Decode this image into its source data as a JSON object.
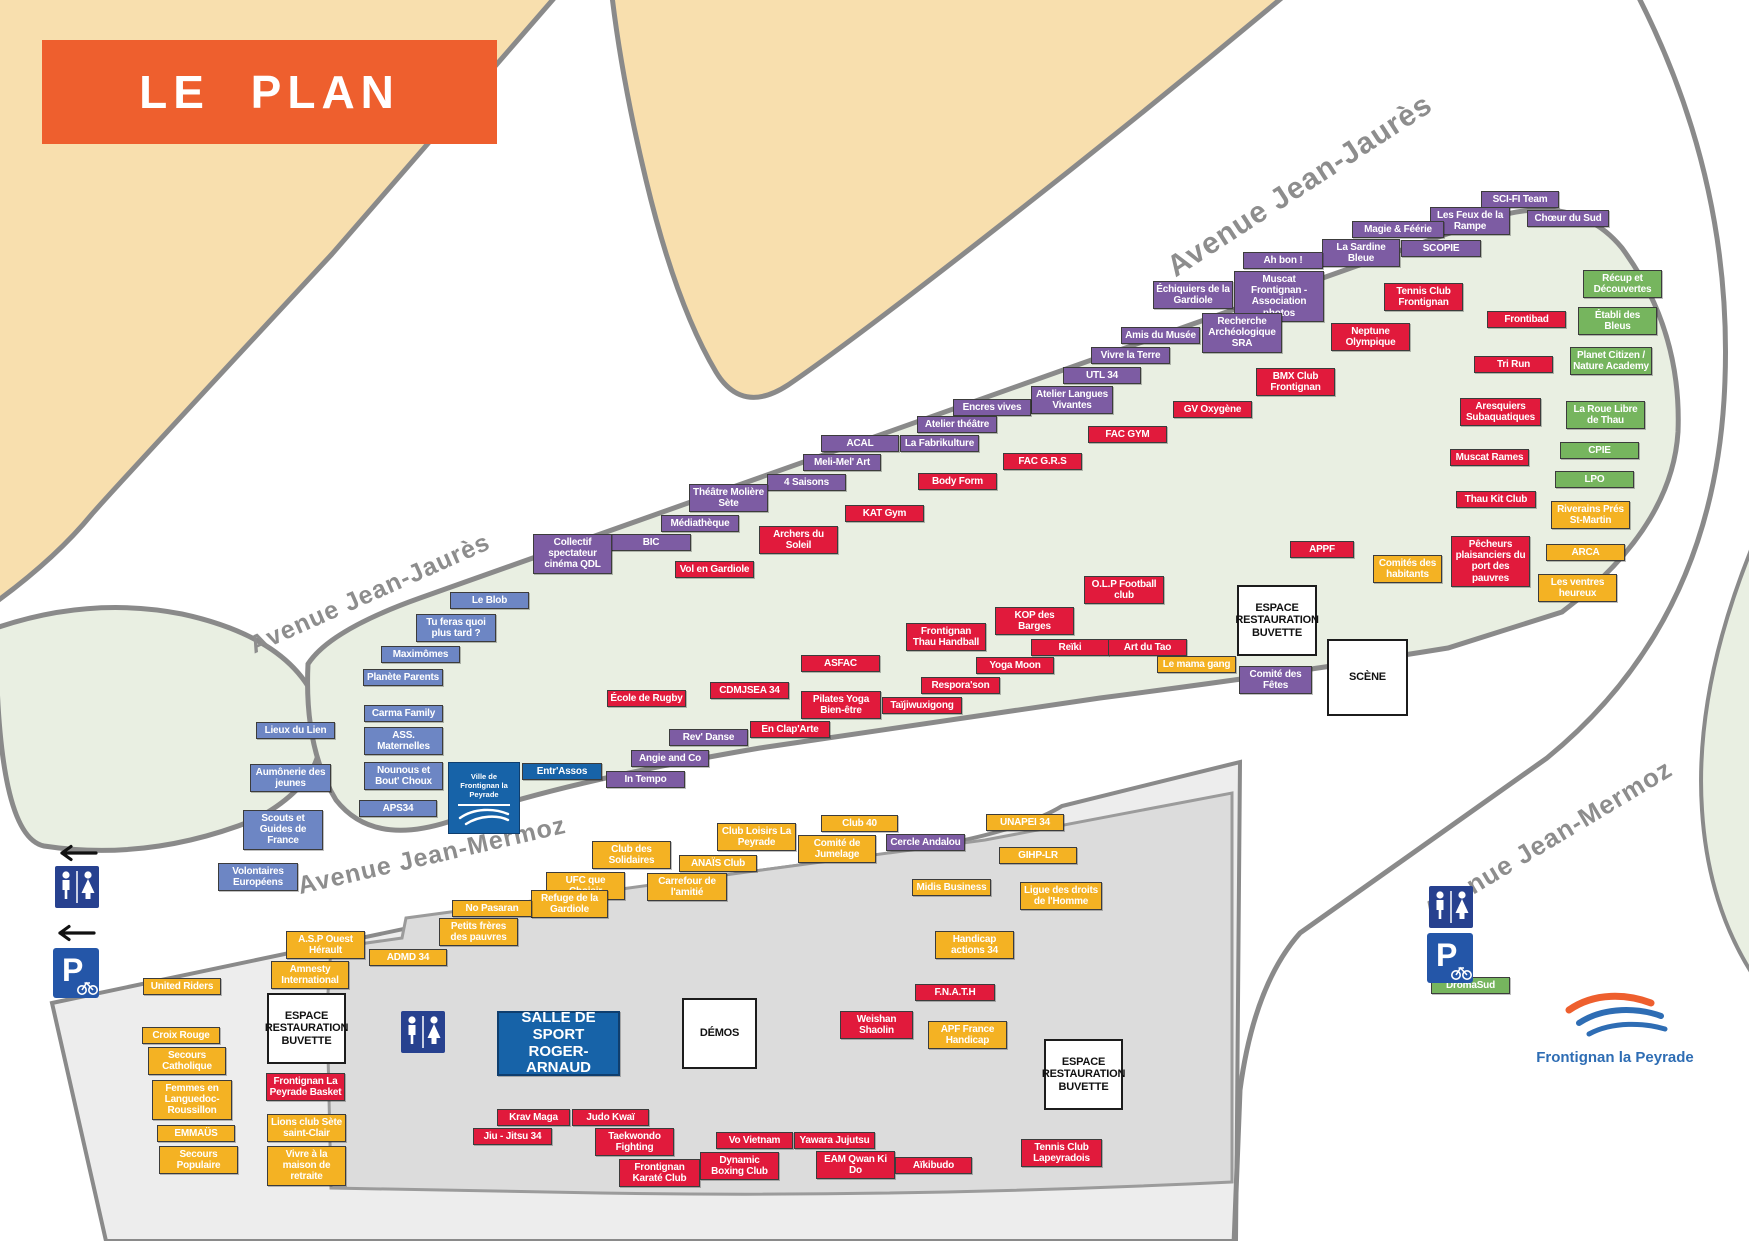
{
  "banner": {
    "title": "LE PLAN"
  },
  "colors": {
    "banner": "#ee5f2e",
    "culture": "#7d5ca3",
    "sport": "#e11a3c",
    "solidarite": "#f4b223",
    "environnement": "#76b55e",
    "jeunesse": "#6d86c4",
    "building": "#1763a8"
  },
  "city_logo": {
    "line1": "Ville de",
    "line2": "Frontignan la Peyrade"
  },
  "footer_logo": {
    "label": "Frontignan la Peyrade"
  },
  "streets": [
    {
      "label": "Avenue Jean-Jaurès",
      "x": 1300,
      "y": 186,
      "angle": -33,
      "size": 30
    },
    {
      "label": "Avenue Jean-Jaurès",
      "x": 370,
      "y": 594,
      "angle": -24,
      "size": 25
    },
    {
      "label": "Avenue Jean-Mermoz",
      "x": 432,
      "y": 856,
      "angle": -13,
      "size": 25
    },
    {
      "label": "Avenue Jean-Mermoz",
      "x": 1548,
      "y": 840,
      "angle": -31,
      "size": 26
    }
  ],
  "icons": [
    {
      "type": "arrow-left",
      "x": 54,
      "y": 843
    },
    {
      "type": "toilets",
      "x": 55,
      "y": 866
    },
    {
      "type": "arrow-left",
      "x": 52,
      "y": 923
    },
    {
      "type": "parking-bike",
      "x": 53,
      "y": 948
    },
    {
      "type": "toilets",
      "x": 401,
      "y": 1011
    },
    {
      "type": "toilets",
      "x": 1429,
      "y": 886
    },
    {
      "type": "parking-bike",
      "x": 1427,
      "y": 933
    }
  ],
  "stands": [
    {
      "label": "SCI-FI Team",
      "cat": "culture",
      "x": 1481,
      "y": 191,
      "w": 78
    },
    {
      "label": "Chœur du Sud",
      "cat": "culture",
      "x": 1527,
      "y": 210,
      "w": 82
    },
    {
      "label": "Les Feux de la Rampe",
      "cat": "culture",
      "x": 1430,
      "y": 207,
      "w": 80
    },
    {
      "label": "Magie & Féérie",
      "cat": "culture",
      "x": 1352,
      "y": 221,
      "w": 92
    },
    {
      "label": "SCOPIE",
      "cat": "culture",
      "x": 1401,
      "y": 240,
      "w": 80
    },
    {
      "label": "La Sardine Bleue",
      "cat": "culture",
      "x": 1322,
      "y": 239,
      "w": 78
    },
    {
      "label": "Ah bon !",
      "cat": "culture",
      "x": 1243,
      "y": 252,
      "w": 80
    },
    {
      "label": "Muscat Frontignan - Association photos",
      "cat": "culture",
      "x": 1234,
      "y": 271,
      "w": 90
    },
    {
      "label": "Échiquiers de la Gardiole",
      "cat": "culture",
      "x": 1153,
      "y": 281,
      "w": 80
    },
    {
      "label": "Recherche Archéologique SRA",
      "cat": "culture",
      "x": 1202,
      "y": 313,
      "w": 80
    },
    {
      "label": "Amis du Musée",
      "cat": "culture",
      "x": 1121,
      "y": 327,
      "w": 79
    },
    {
      "label": "Vivre la Terre",
      "cat": "culture",
      "x": 1091,
      "y": 347,
      "w": 79
    },
    {
      "label": "UTL 34",
      "cat": "culture",
      "x": 1063,
      "y": 367,
      "w": 78
    },
    {
      "label": "Atelier Langues Vivantes",
      "cat": "culture",
      "x": 1031,
      "y": 386,
      "w": 82
    },
    {
      "label": "Encres vives",
      "cat": "culture",
      "x": 953,
      "y": 399,
      "w": 78
    },
    {
      "label": "Atelier théâtre",
      "cat": "culture",
      "x": 917,
      "y": 416,
      "w": 80
    },
    {
      "label": "La Fabrikulture",
      "cat": "culture",
      "x": 900,
      "y": 435,
      "w": 79
    },
    {
      "label": "ACAL",
      "cat": "culture",
      "x": 821,
      "y": 435,
      "w": 78
    },
    {
      "label": "Meli-Mel' Art",
      "cat": "culture",
      "x": 803,
      "y": 454,
      "w": 78
    },
    {
      "label": "4 Saisons",
      "cat": "culture",
      "x": 767,
      "y": 474,
      "w": 79
    },
    {
      "label": "Théâtre Molière Sète",
      "cat": "culture",
      "x": 689,
      "y": 484,
      "w": 79
    },
    {
      "label": "Médiathèque",
      "cat": "culture",
      "x": 661,
      "y": 515,
      "w": 78
    },
    {
      "label": "BIC",
      "cat": "culture",
      "x": 611,
      "y": 534,
      "w": 80
    },
    {
      "label": "Collectif spectateur cinéma QDL",
      "cat": "culture",
      "x": 533,
      "y": 534,
      "w": 79
    },
    {
      "label": "Cercle Andalou",
      "cat": "culture",
      "x": 886,
      "y": 834,
      "w": 79
    },
    {
      "label": "Comité des Fêtes",
      "cat": "culture",
      "x": 1239,
      "y": 666,
      "w": 73
    },
    {
      "label": "Rev' Danse",
      "cat": "culture",
      "x": 669,
      "y": 729,
      "w": 79
    },
    {
      "label": "Angie and Co",
      "cat": "culture",
      "x": 631,
      "y": 750,
      "w": 78
    },
    {
      "label": "In Tempo",
      "cat": "culture",
      "x": 606,
      "y": 771,
      "w": 79
    },
    {
      "label": "Le Blob",
      "cat": "jeunesse",
      "x": 450,
      "y": 592,
      "w": 79
    },
    {
      "label": "Tu feras quoi plus tard ?",
      "cat": "jeunesse",
      "x": 416,
      "y": 614,
      "w": 80
    },
    {
      "label": "Maximômes",
      "cat": "jeunesse",
      "x": 381,
      "y": 646,
      "w": 79
    },
    {
      "label": "Planète Parents",
      "cat": "jeunesse",
      "x": 363,
      "y": 669,
      "w": 80
    },
    {
      "label": "Carma Family",
      "cat": "jeunesse",
      "x": 364,
      "y": 705,
      "w": 79
    },
    {
      "label": "ASS. Maternelles",
      "cat": "jeunesse",
      "x": 364,
      "y": 727,
      "w": 79
    },
    {
      "label": "Nounous et Bout' Choux",
      "cat": "jeunesse",
      "x": 364,
      "y": 762,
      "w": 79
    },
    {
      "label": "APS34",
      "cat": "jeunesse",
      "x": 359,
      "y": 800,
      "w": 78
    },
    {
      "label": "Lieux du Lien",
      "cat": "jeunesse",
      "x": 256,
      "y": 722,
      "w": 79
    },
    {
      "label": "Aumônerie des jeunes",
      "cat": "jeunesse",
      "x": 250,
      "y": 764,
      "w": 81
    },
    {
      "label": "Scouts et Guides de France",
      "cat": "jeunesse",
      "x": 243,
      "y": 810,
      "w": 80
    },
    {
      "label": "Volontaires Européens",
      "cat": "jeunesse",
      "x": 218,
      "y": 863,
      "w": 80
    },
    {
      "label": "Tennis Club Frontignan",
      "cat": "sport",
      "x": 1384,
      "y": 283,
      "w": 79
    },
    {
      "label": "Neptune Olympique",
      "cat": "sport",
      "x": 1331,
      "y": 323,
      "w": 79
    },
    {
      "label": "Frontibad",
      "cat": "sport",
      "x": 1487,
      "y": 311,
      "w": 79
    },
    {
      "label": "Tri Run",
      "cat": "sport",
      "x": 1474,
      "y": 356,
      "w": 79
    },
    {
      "label": "BMX Club Frontignan",
      "cat": "sport",
      "x": 1256,
      "y": 368,
      "w": 79
    },
    {
      "label": "GV Oxygène",
      "cat": "sport",
      "x": 1173,
      "y": 401,
      "w": 79
    },
    {
      "label": "Aresquiers Subaquatiques",
      "cat": "sport",
      "x": 1460,
      "y": 398,
      "w": 81
    },
    {
      "label": "Muscat Rames",
      "cat": "sport",
      "x": 1450,
      "y": 449,
      "w": 79
    },
    {
      "label": "Thau Kit Club",
      "cat": "sport",
      "x": 1456,
      "y": 491,
      "w": 80
    },
    {
      "label": "Pêcheurs plaisanciers du port des pauvres",
      "cat": "sport",
      "x": 1451,
      "y": 536,
      "w": 79
    },
    {
      "label": "FAC GYM",
      "cat": "sport",
      "x": 1088,
      "y": 426,
      "w": 79
    },
    {
      "label": "FAC G.R.S",
      "cat": "sport",
      "x": 1003,
      "y": 453,
      "w": 79
    },
    {
      "label": "Body Form",
      "cat": "sport",
      "x": 918,
      "y": 473,
      "w": 79
    },
    {
      "label": "KAT Gym",
      "cat": "sport",
      "x": 845,
      "y": 505,
      "w": 79
    },
    {
      "label": "Archers du Soleil",
      "cat": "sport",
      "x": 759,
      "y": 526,
      "w": 79
    },
    {
      "label": "Vol en Gardiole",
      "cat": "sport",
      "x": 675,
      "y": 561,
      "w": 79
    },
    {
      "label": "O.L.P Football club",
      "cat": "sport",
      "x": 1084,
      "y": 576,
      "w": 80
    },
    {
      "label": "KOP des Barges",
      "cat": "sport",
      "x": 995,
      "y": 607,
      "w": 79
    },
    {
      "label": "Frontignan Thau Handball",
      "cat": "sport",
      "x": 906,
      "y": 623,
      "w": 80
    },
    {
      "label": "Reïki",
      "cat": "sport",
      "x": 1031,
      "y": 639,
      "w": 78
    },
    {
      "label": "Art du Tao",
      "cat": "sport",
      "x": 1108,
      "y": 639,
      "w": 79
    },
    {
      "label": "Yoga Moon",
      "cat": "sport",
      "x": 976,
      "y": 657,
      "w": 78
    },
    {
      "label": "Respora'son",
      "cat": "sport",
      "x": 921,
      "y": 677,
      "w": 79
    },
    {
      "label": "ASFAC",
      "cat": "sport",
      "x": 801,
      "y": 655,
      "w": 79
    },
    {
      "label": "Pilates Yoga Bien-être",
      "cat": "sport",
      "x": 801,
      "y": 691,
      "w": 80
    },
    {
      "label": "Taïjiwuxigong",
      "cat": "sport",
      "x": 882,
      "y": 697,
      "w": 80
    },
    {
      "label": "École de Rugby",
      "cat": "sport",
      "x": 607,
      "y": 690,
      "w": 79
    },
    {
      "label": "CDMJSEA 34",
      "cat": "sport",
      "x": 710,
      "y": 682,
      "w": 79
    },
    {
      "label": "En Clap'Arte",
      "cat": "sport",
      "x": 750,
      "y": 721,
      "w": 80
    },
    {
      "label": "APPF",
      "cat": "sport",
      "x": 1290,
      "y": 541,
      "w": 64
    },
    {
      "label": "Frontignan La Peyrade Basket",
      "cat": "sport",
      "x": 266,
      "y": 1073,
      "w": 79
    },
    {
      "label": "Weishan Shaolin",
      "cat": "sport",
      "x": 840,
      "y": 1011,
      "w": 73
    },
    {
      "label": "F.N.A.T.H",
      "cat": "sport",
      "x": 915,
      "y": 984,
      "w": 80
    },
    {
      "label": "Krav Maga",
      "cat": "sport",
      "x": 497,
      "y": 1109,
      "w": 73
    },
    {
      "label": "Judo Kwaï",
      "cat": "sport",
      "x": 572,
      "y": 1109,
      "w": 77
    },
    {
      "label": "Jiu - Jitsu 34",
      "cat": "sport",
      "x": 473,
      "y": 1128,
      "w": 79
    },
    {
      "label": "Taekwondo Fighting",
      "cat": "sport",
      "x": 595,
      "y": 1128,
      "w": 79
    },
    {
      "label": "Frontignan Karaté Club",
      "cat": "sport",
      "x": 619,
      "y": 1159,
      "w": 81
    },
    {
      "label": "Dynamic Boxing Club",
      "cat": "sport",
      "x": 700,
      "y": 1152,
      "w": 79
    },
    {
      "label": "Vo Vietnam",
      "cat": "sport",
      "x": 716,
      "y": 1132,
      "w": 77
    },
    {
      "label": "Yawara Jujutsu",
      "cat": "sport",
      "x": 794,
      "y": 1132,
      "w": 81
    },
    {
      "label": "EAM Qwan Ki Do",
      "cat": "sport",
      "x": 816,
      "y": 1151,
      "w": 79
    },
    {
      "label": "Aïkibudo",
      "cat": "sport",
      "x": 895,
      "y": 1157,
      "w": 77
    },
    {
      "label": "Tennis Club Lapeyradois",
      "cat": "sport",
      "x": 1021,
      "y": 1139,
      "w": 81
    },
    {
      "label": "Riverains Prés St-Martin",
      "cat": "solidarite",
      "x": 1551,
      "y": 501,
      "w": 79
    },
    {
      "label": "ARCA",
      "cat": "solidarite",
      "x": 1546,
      "y": 544,
      "w": 79
    },
    {
      "label": "Les ventres heureux",
      "cat": "solidarite",
      "x": 1538,
      "y": 574,
      "w": 79
    },
    {
      "label": "Comités des habitants",
      "cat": "solidarite",
      "x": 1373,
      "y": 555,
      "w": 69
    },
    {
      "label": "Le mama gang",
      "cat": "solidarite",
      "x": 1157,
      "y": 656,
      "w": 79
    },
    {
      "label": "Club 40",
      "cat": "solidarite",
      "x": 821,
      "y": 815,
      "w": 77
    },
    {
      "label": "Comité de Jumelage",
      "cat": "solidarite",
      "x": 798,
      "y": 835,
      "w": 78
    },
    {
      "label": "Club Loisirs La Peyrade",
      "cat": "solidarite",
      "x": 717,
      "y": 823,
      "w": 79
    },
    {
      "label": "UNAPEI 34",
      "cat": "solidarite",
      "x": 986,
      "y": 814,
      "w": 78
    },
    {
      "label": "GIHP-LR",
      "cat": "solidarite",
      "x": 999,
      "y": 847,
      "w": 78
    },
    {
      "label": "Ligue des droits de l'Homme",
      "cat": "solidarite",
      "x": 1020,
      "y": 882,
      "w": 82
    },
    {
      "label": "Midis Business",
      "cat": "solidarite",
      "x": 912,
      "y": 879,
      "w": 79
    },
    {
      "label": "Handicap actions 34",
      "cat": "solidarite",
      "x": 935,
      "y": 931,
      "w": 79
    },
    {
      "label": "Club des Solidaires",
      "cat": "solidarite",
      "x": 592,
      "y": 841,
      "w": 79
    },
    {
      "label": "ANAÏS Club",
      "cat": "solidarite",
      "x": 679,
      "y": 855,
      "w": 78
    },
    {
      "label": "UFC que Choisir",
      "cat": "solidarite",
      "x": 546,
      "y": 872,
      "w": 79
    },
    {
      "label": "Carrefour de l'amitié",
      "cat": "solidarite",
      "x": 647,
      "y": 873,
      "w": 80
    },
    {
      "label": "Refuge de la Gardiole",
      "cat": "solidarite",
      "x": 531,
      "y": 890,
      "w": 77
    },
    {
      "label": "No Pasaran",
      "cat": "solidarite",
      "x": 452,
      "y": 900,
      "w": 80
    },
    {
      "label": "Petits frères des pauvres",
      "cat": "solidarite",
      "x": 439,
      "y": 918,
      "w": 79
    },
    {
      "label": "A.S.P Ouest Hérault",
      "cat": "solidarite",
      "x": 286,
      "y": 931,
      "w": 79
    },
    {
      "label": "ADMD 34",
      "cat": "solidarite",
      "x": 369,
      "y": 949,
      "w": 78
    },
    {
      "label": "Amnesty International",
      "cat": "solidarite",
      "x": 271,
      "y": 961,
      "w": 78
    },
    {
      "label": "United Riders",
      "cat": "solidarite",
      "x": 143,
      "y": 978,
      "w": 78
    },
    {
      "label": "Croix Rouge",
      "cat": "solidarite",
      "x": 142,
      "y": 1027,
      "w": 78
    },
    {
      "label": "Secours Catholique",
      "cat": "solidarite",
      "x": 148,
      "y": 1047,
      "w": 78
    },
    {
      "label": "Femmes en Languedoc- Roussillon",
      "cat": "solidarite",
      "x": 152,
      "y": 1080,
      "w": 80
    },
    {
      "label": "EMMAÜS",
      "cat": "solidarite",
      "x": 157,
      "y": 1125,
      "w": 78
    },
    {
      "label": "Secours Populaire",
      "cat": "solidarite",
      "x": 159,
      "y": 1146,
      "w": 79
    },
    {
      "label": "Lions club Sète saint-Clair",
      "cat": "solidarite",
      "x": 267,
      "y": 1114,
      "w": 79
    },
    {
      "label": "Vivre à la maison de retraite",
      "cat": "solidarite",
      "x": 267,
      "y": 1146,
      "w": 79
    },
    {
      "label": "APF France Handicap",
      "cat": "solidarite",
      "x": 928,
      "y": 1021,
      "w": 79
    },
    {
      "label": "Récup et Découvertes",
      "cat": "environnement",
      "x": 1583,
      "y": 270,
      "w": 79
    },
    {
      "label": "Établi des Bleus",
      "cat": "environnement",
      "x": 1578,
      "y": 307,
      "w": 79
    },
    {
      "label": "Planet Citizen / Nature Academy",
      "cat": "environnement",
      "x": 1570,
      "y": 347,
      "w": 82
    },
    {
      "label": "La Roue Libre de Thau",
      "cat": "environnement",
      "x": 1566,
      "y": 401,
      "w": 79
    },
    {
      "label": "CPIE",
      "cat": "environnement",
      "x": 1560,
      "y": 442,
      "w": 79
    },
    {
      "label": "LPO",
      "cat": "environnement",
      "x": 1555,
      "y": 471,
      "w": 79
    },
    {
      "label": "DromaSud",
      "cat": "environnement",
      "x": 1431,
      "y": 977,
      "w": 79
    },
    {
      "label": "Entr'Assos",
      "cat": "building",
      "x": 522,
      "y": 763,
      "w": 80
    },
    {
      "label": "ESPACE RESTAURATION BUVETTE",
      "cat": "info",
      "x": 1237,
      "y": 585,
      "w": 80,
      "h": 71
    },
    {
      "label": "SCÈNE",
      "cat": "info",
      "x": 1327,
      "y": 639,
      "w": 81,
      "h": 77
    },
    {
      "label": "ESPACE RESTAURATION BUVETTE",
      "cat": "info",
      "x": 267,
      "y": 993,
      "w": 79,
      "h": 71
    },
    {
      "label": "ESPACE RESTAURATION BUVETTE",
      "cat": "info",
      "x": 1044,
      "y": 1039,
      "w": 79,
      "h": 71
    },
    {
      "label": "DÉMOS",
      "cat": "info",
      "x": 682,
      "y": 998,
      "w": 75,
      "h": 71
    },
    {
      "label": "SALLE DE SPORT ROGER-ARNAUD",
      "cat": "salle",
      "x": 497,
      "y": 1011,
      "w": 123,
      "h": 65
    }
  ]
}
